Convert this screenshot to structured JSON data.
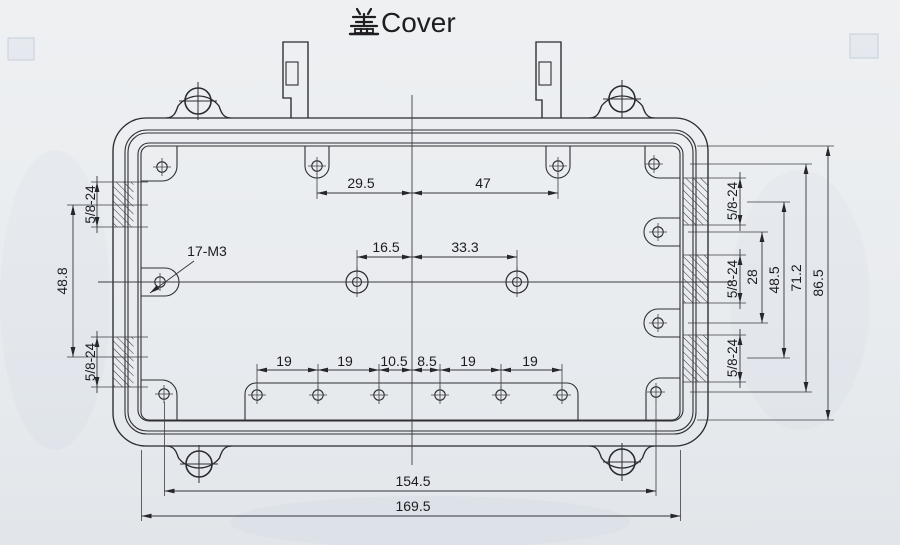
{
  "title": {
    "full": "盖Cover",
    "cjk": "盖",
    "latin": "Cover"
  },
  "drawing": {
    "part": "cover-plate",
    "thread_note": "17-M3",
    "dims": {
      "top_left_span": "29.5",
      "top_right_span": "47",
      "mid_left_span": "16.5",
      "mid_right_span": "33.3",
      "bottom_row": [
        "19",
        "19",
        "10.5",
        "8.5",
        "19",
        "19"
      ],
      "bottom_width_inner": "154.5",
      "bottom_width_outer": "169.5",
      "left_bushing_spacing": "48.8",
      "thread_left_top": "5/8-24",
      "thread_left_bottom": "5/8-24",
      "thread_right_top": "5/8-24",
      "thread_right_mid": "5/8-24",
      "thread_right_bottom": "5/8-24",
      "right_tab_gap": "28",
      "right_bushing_span": "48.5",
      "right_tab_span": "71.2",
      "cavity_height": "86.5"
    }
  },
  "colors": {
    "paper": "#eaedf0",
    "line": "#2a2a31",
    "text": "#1b1b21"
  }
}
